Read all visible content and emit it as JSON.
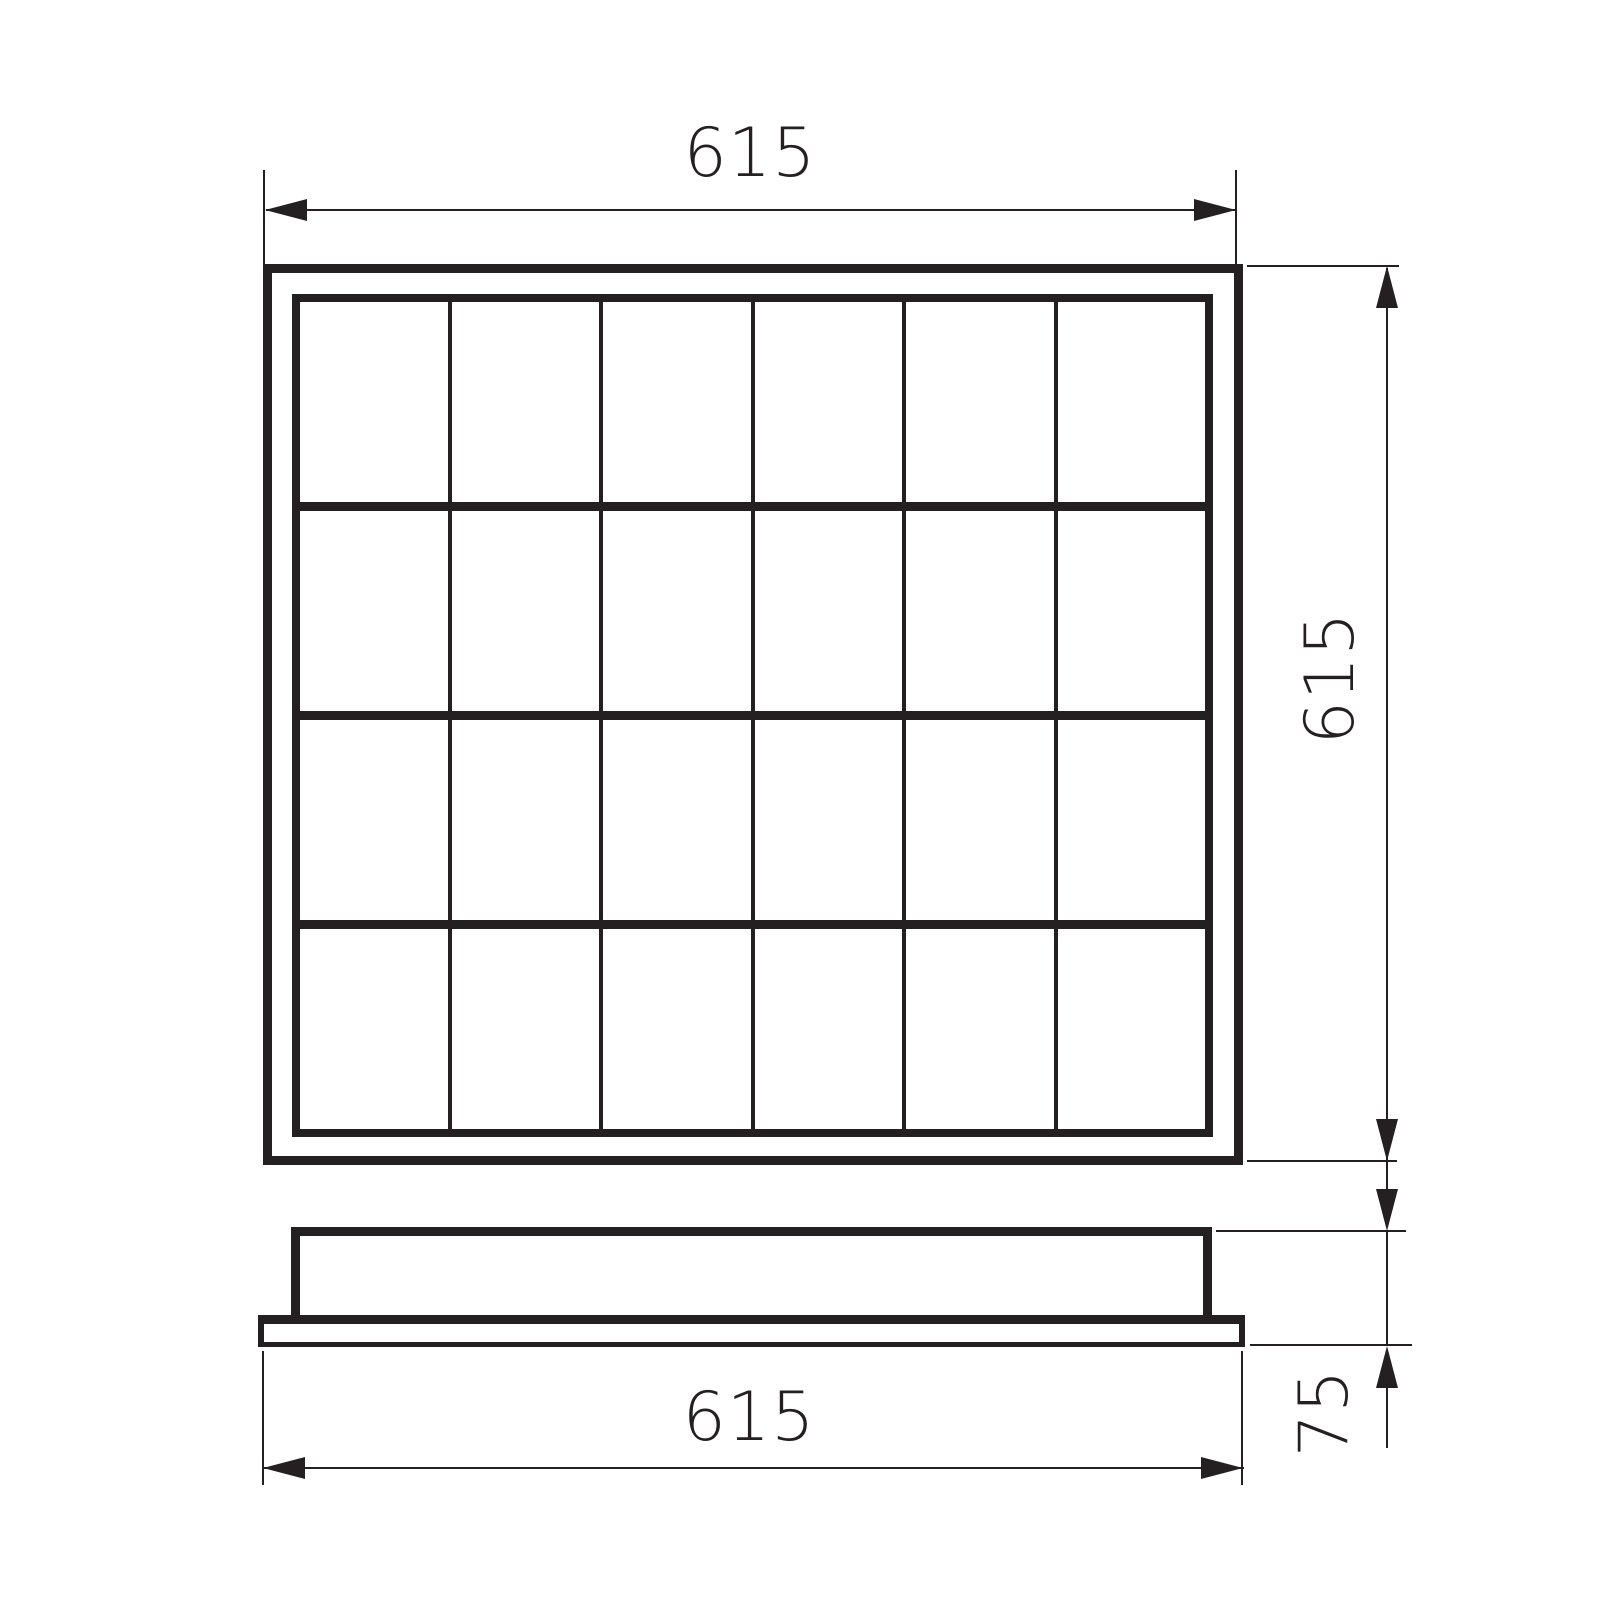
{
  "style": {
    "line_color": "#241f20",
    "background_color": "#ffffff"
  },
  "top_view": {
    "grid_columns": 6,
    "grid_rows": 4
  },
  "dimensions": {
    "top_width": "615",
    "right_height": "615",
    "bottom_width": "615",
    "side_height": "75"
  },
  "icons": {
    "arrowhead": "filled-triangle"
  }
}
